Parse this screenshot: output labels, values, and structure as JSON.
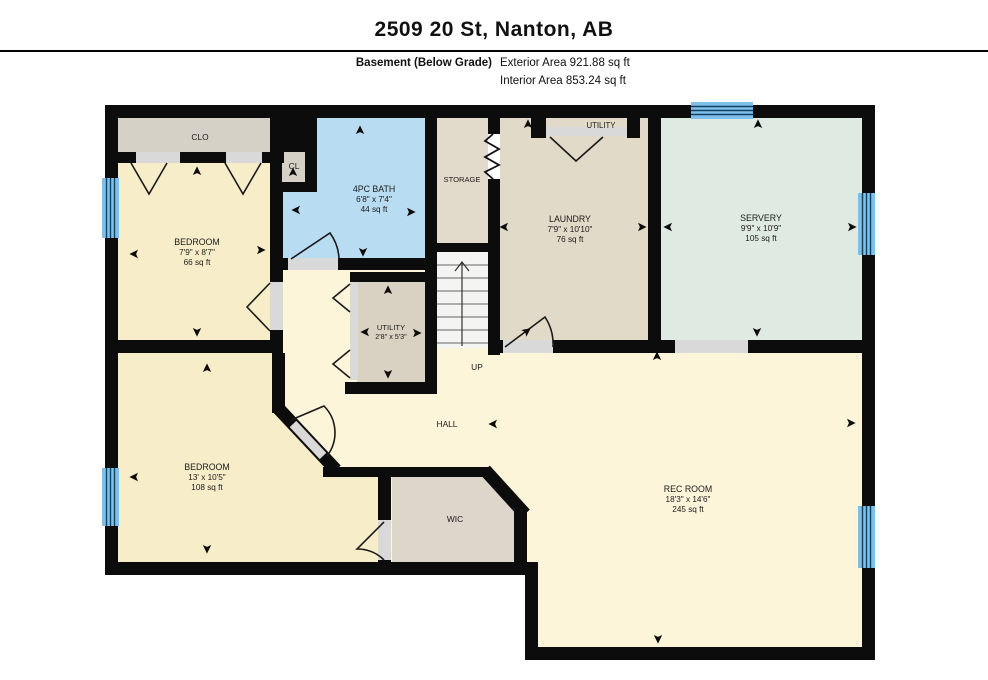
{
  "header": {
    "title": "2509 20 St, Nanton, AB",
    "floor_label": "Basement (Below Grade)",
    "exterior_area": "Exterior Area 921.88 sq ft",
    "interior_area": "Interior Area 853.24 sq ft"
  },
  "plan": {
    "rooms": {
      "clo": {
        "label": "CLO"
      },
      "cl": {
        "label": "CL"
      },
      "bedroom1": {
        "label": "BEDROOM",
        "dims": "7'9\" x 8'7\"",
        "area": "66 sq ft"
      },
      "bath": {
        "label": "4PC BATH",
        "dims": "6'8\" x 7'4\"",
        "area": "44 sq ft"
      },
      "storage": {
        "label": "STORAGE"
      },
      "utility_closet": {
        "label": "UTILITY",
        "dims": "2'8\" x 5'3\""
      },
      "laundry": {
        "label": "LAUNDRY",
        "dims": "7'9\" x 10'10\"",
        "area": "76 sq ft"
      },
      "utility_nook": {
        "label": "UTILITY"
      },
      "servery": {
        "label": "SERVERY",
        "dims": "9'9\" x 10'9\"",
        "area": "105 sq ft"
      },
      "bedroom2": {
        "label": "BEDROOM",
        "dims": "13' x 10'5\"",
        "area": "108 sq ft"
      },
      "wic": {
        "label": "WIC"
      },
      "hall": {
        "label": "HALL"
      },
      "rec_room": {
        "label": "REC ROOM",
        "dims": "18'3\" x 14'6\"",
        "area": "245 sq ft"
      },
      "stairs": {
        "label": "UP"
      }
    },
    "colors": {
      "wall": "#0c0c0c",
      "window_blue": "#7fc0ea",
      "bath_blue": "#b8dcf2",
      "servery_mint": "#dfeae3",
      "bedroom_cream": "#f8edc9",
      "hall_cream": "#fdf5da",
      "laundry_beige": "#e2dac8",
      "closet_gray": "#d5d1c6",
      "opening_gray": "#d9d9d9"
    }
  }
}
